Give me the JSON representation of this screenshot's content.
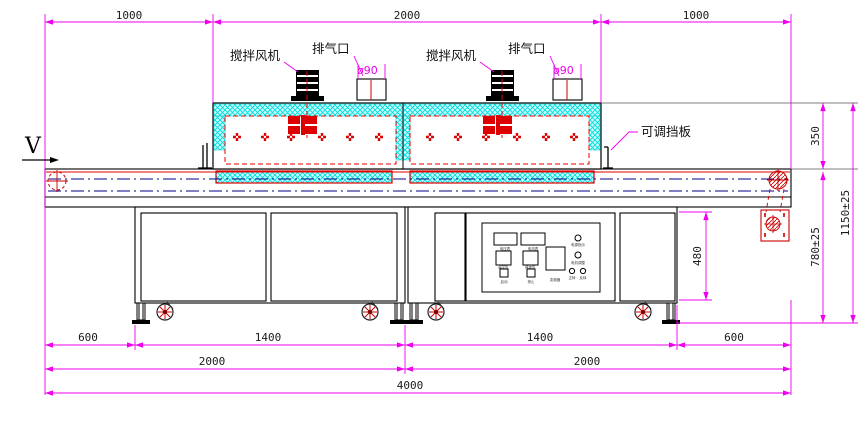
{
  "drawing": {
    "labels": {
      "fan": "搅拌风机",
      "exhaust": "排气口",
      "exhaust_diameter": "ø90",
      "baffle": "可调挡板",
      "direction": "V"
    },
    "dimensions": {
      "top_left": "1000",
      "top_mid": "2000",
      "top_right": "1000",
      "oven_height": "350",
      "total_height": "1150±25",
      "table_height": "780±25",
      "cabinet_height": "480",
      "bottom_600_left": "600",
      "bottom_1400_left": "1400",
      "bottom_1400_right": "1400",
      "bottom_600_right": "600",
      "bottom_2000_left": "2000",
      "bottom_2000_right": "2000",
      "bottom_total": "4000"
    },
    "panel": {
      "voltmeter": "电压表",
      "ammeter": "电流表",
      "power_lamp": "电源指示",
      "temp_controller": "温控仪",
      "speed_controller": "调速仪",
      "inverter": "变频器",
      "motor_group": "电机调整",
      "lamp_fwd": "正转",
      "lamp_rev": "反转",
      "btn_start": "启动",
      "btn_stop": "停止"
    },
    "colors": {
      "dimension": "#ee00ee",
      "structure": "#000000",
      "heater": "#dd0000",
      "insulation": "#00dcdc",
      "centerline": "#000088"
    }
  }
}
